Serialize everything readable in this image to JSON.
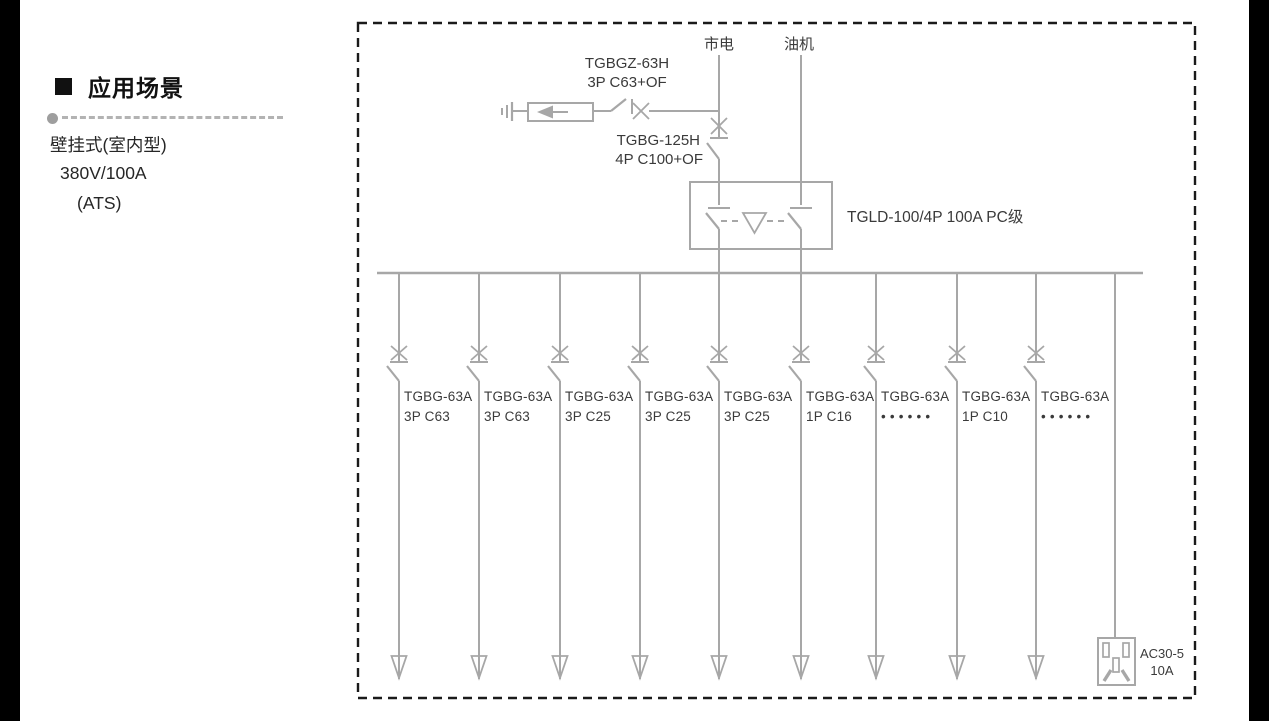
{
  "colors": {
    "diagram_line": "#a7a7a7",
    "dashed_border": "#1a1a1a",
    "diagram_text": "#3a3a3a",
    "sidebar_text": "#262626",
    "separator": "#9e9e9e"
  },
  "sidebar": {
    "heading": "应用场景",
    "lines": [
      "壁挂式(室内型)",
      "380V/100A",
      "(ATS)"
    ]
  },
  "diagram": {
    "source_mains": "市电",
    "source_generator": "油机",
    "spd": {
      "model": "TGBGZ-63H",
      "spec": "3P C63+OF"
    },
    "incomer": {
      "model": "TGBG-125H",
      "spec": "4P C100+OF"
    },
    "ats": {
      "label": "TGLD-100/4P 100A PC级"
    },
    "branches": [
      {
        "model": "TGBG-63A",
        "spec": "3P C63"
      },
      {
        "model": "TGBG-63A",
        "spec": "3P C63"
      },
      {
        "model": "TGBG-63A",
        "spec": "3P C25"
      },
      {
        "model": "TGBG-63A",
        "spec": "3P C25"
      },
      {
        "model": "TGBG-63A",
        "spec": "3P C25"
      },
      {
        "model": "TGBG-63A",
        "spec": "1P C16"
      },
      {
        "model": "TGBG-63A",
        "spec": "• • • • • •"
      },
      {
        "model": "TGBG-63A",
        "spec": "1P C10"
      },
      {
        "model": "TGBG-63A",
        "spec": "• • • • • •"
      }
    ],
    "socket": {
      "model": "AC30-5",
      "rating": "10A"
    }
  }
}
